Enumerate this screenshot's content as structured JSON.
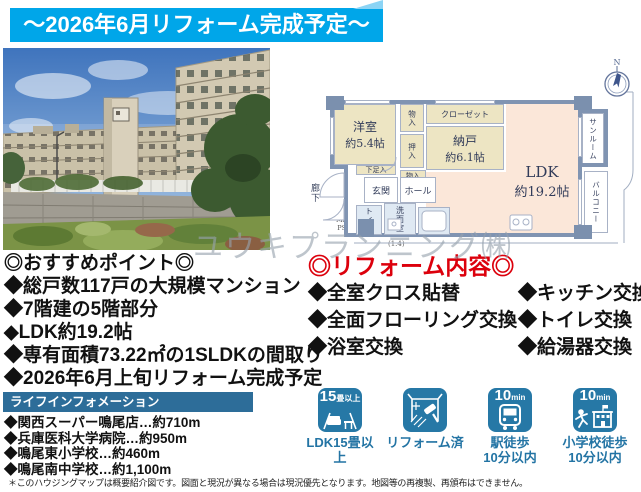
{
  "banner": {
    "text": "〜2026年6月リフォーム完成予定〜"
  },
  "watermark": "ユウキプランニング㈱",
  "floorplan": {
    "compass": "N",
    "rooms": {
      "western": {
        "name": "洋室",
        "size": "約5.4帖"
      },
      "storage_room": {
        "name": "納戸",
        "size": "約6.1帖"
      },
      "ldk": {
        "name": "LDK",
        "size": "約19.2帖"
      },
      "closet": "クローゼット",
      "mono_top": "物入",
      "oshiire": "押入",
      "mono_mid": "物入",
      "shoe_box": "下足入",
      "entrance": "玄関",
      "hall": "ホール",
      "toilet": "トイレ",
      "washroom": "洗面室",
      "bathroom": "浴室",
      "sunroom": "サンルーム",
      "balcony": "バルコニー",
      "corridor": "廊下",
      "mb": "MB",
      "ps": "PS",
      "note": "(1.4)"
    }
  },
  "points": {
    "title": "◎おすすめポイント◎",
    "items": [
      "◆総戸数117戸の大規模マンション",
      "◆7階建の5階部分",
      "◆LDK約19.2帖",
      "◆専有面積73.22㎡の1SLDKの間取り",
      "◆2026年6月上旬リフォーム完成予定"
    ]
  },
  "reform": {
    "title": "◎リフォーム内容◎",
    "left": [
      "◆全室クロス貼替",
      "◆全面フローリング交換",
      "◆浴室交換"
    ],
    "right": [
      "◆キッチン交換",
      "◆トイレ交換",
      "◆給湯器交換"
    ]
  },
  "lifeinfo": {
    "heading": "ライフインフォメーション",
    "items": [
      "◆関西スーパー鳴尾店…約710m",
      "◆兵庫医科大学病院…約950m",
      "◆鳴尾東小学校…約460m",
      "◆鳴尾南中学校…約1,100m"
    ]
  },
  "badges": [
    {
      "caption_big": "15",
      "caption_small": "畳以上",
      "label": "LDK15畳以上"
    },
    {
      "caption_big": "",
      "caption_small": "",
      "label": "リフォーム済"
    },
    {
      "caption_big": "10",
      "caption_small": "min",
      "label": "駅徒歩\n10分以内"
    },
    {
      "caption_big": "10",
      "caption_small": "min",
      "label": "小学校徒歩\n10分以内"
    }
  ],
  "footer": "＊このハウジングマップは概要紹介図です。図面と現況が異なる場合は現況優先となります。地図等の再複製、再頒布はできません。",
  "colors": {
    "banner_blue": "#00a6e9",
    "accent_red": "#dc000c",
    "life_banner": "#2d6d99",
    "badge_blue": "#2678a6"
  }
}
